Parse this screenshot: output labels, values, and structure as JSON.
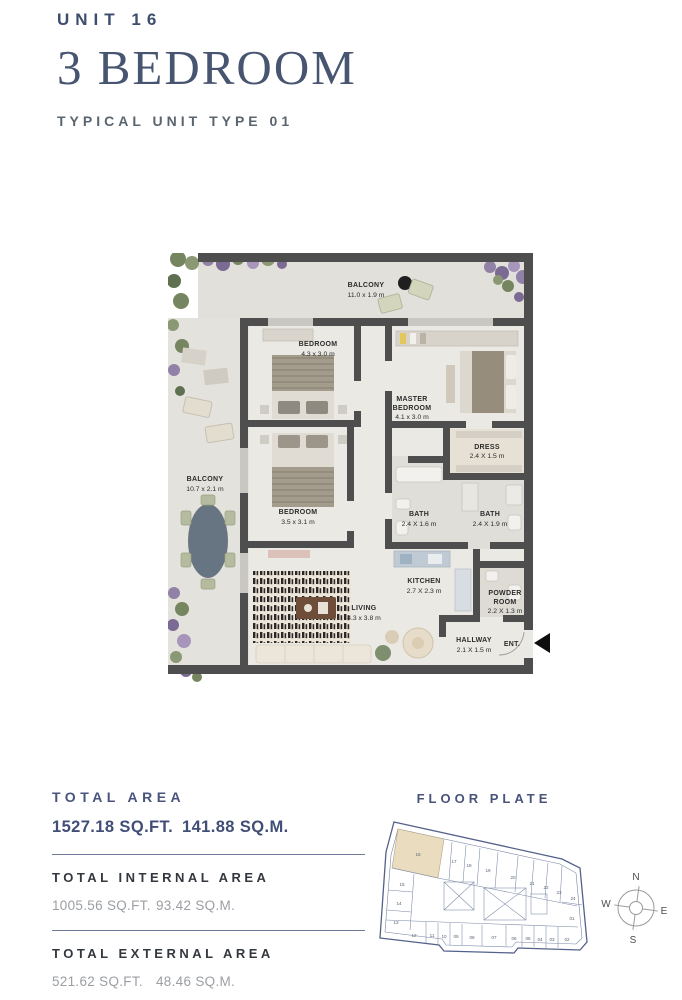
{
  "header": {
    "unit": "UNIT 16",
    "title": "3 BEDROOM",
    "subtitle": "TYPICAL UNIT TYPE 01"
  },
  "plan": {
    "balcony_top": {
      "name": "BALCONY",
      "dims": "11.0 x 1.9 m"
    },
    "bedroom1": {
      "name": "BEDROOM",
      "dims": "4.3 x 3.0 m"
    },
    "master": {
      "name1": "MASTER",
      "name2": "BEDROOM",
      "dims": "4.1 x 3.0 m"
    },
    "dress": {
      "name": "DRESS",
      "dims": "2.4 X 1.5 m"
    },
    "balcony_left": {
      "name": "BALCONY",
      "dims": "10.7 x 2.1 m"
    },
    "bedroom2": {
      "name": "BEDROOM",
      "dims": "3.5 x 3.1 m"
    },
    "bath1": {
      "name": "BATH",
      "dims": "2.4 X 1.6 m"
    },
    "bath2": {
      "name": "BATH",
      "dims": "2.4 X 1.9 m"
    },
    "kitchen": {
      "name": "KITCHEN",
      "dims": "2.7 X 2.3 m"
    },
    "powder": {
      "name1": "POWDER",
      "name2": "ROOM",
      "dims": "2.2 X 1.3 m"
    },
    "living": {
      "name": "LIVING",
      "dims": "4.3 x 3.8 m"
    },
    "hallway": {
      "name": "HALLWAY",
      "dims": "2.1 X 1.5 m"
    },
    "entrance": {
      "label": "ENT."
    }
  },
  "areas": {
    "total": {
      "title": "TOTAL AREA",
      "sqft": "1527.18 SQ.FT.",
      "sqm": "141.88 SQ.M."
    },
    "internal": {
      "title": "TOTAL INTERNAL AREA",
      "sqft": "1005.56 SQ.FT.",
      "sqm": "93.42 SQ.M."
    },
    "external": {
      "title": "TOTAL EXTERNAL AREA",
      "sqft": "521.62 SQ.FT.",
      "sqm": "48.46 SQ.M."
    }
  },
  "floor_plate": {
    "title": "FLOOR PLATE",
    "highlighted_unit": "16",
    "units": [
      "16",
      "17",
      "18",
      "19",
      "20",
      "21",
      "22",
      "23",
      "24",
      "15",
      "14",
      "13",
      "12",
      "11",
      "10",
      "09",
      "08",
      "07",
      "06",
      "05",
      "04",
      "03",
      "02",
      "01"
    ]
  },
  "compass": {
    "n": "N",
    "e": "E",
    "s": "S",
    "w": "W"
  },
  "colors": {
    "accent_navy": "#46536e",
    "wall": "#4e4e4e",
    "floor": "#eae8e3",
    "balcony_floor": "#e2e0da",
    "highlight_beige": "#e9dcbf"
  }
}
